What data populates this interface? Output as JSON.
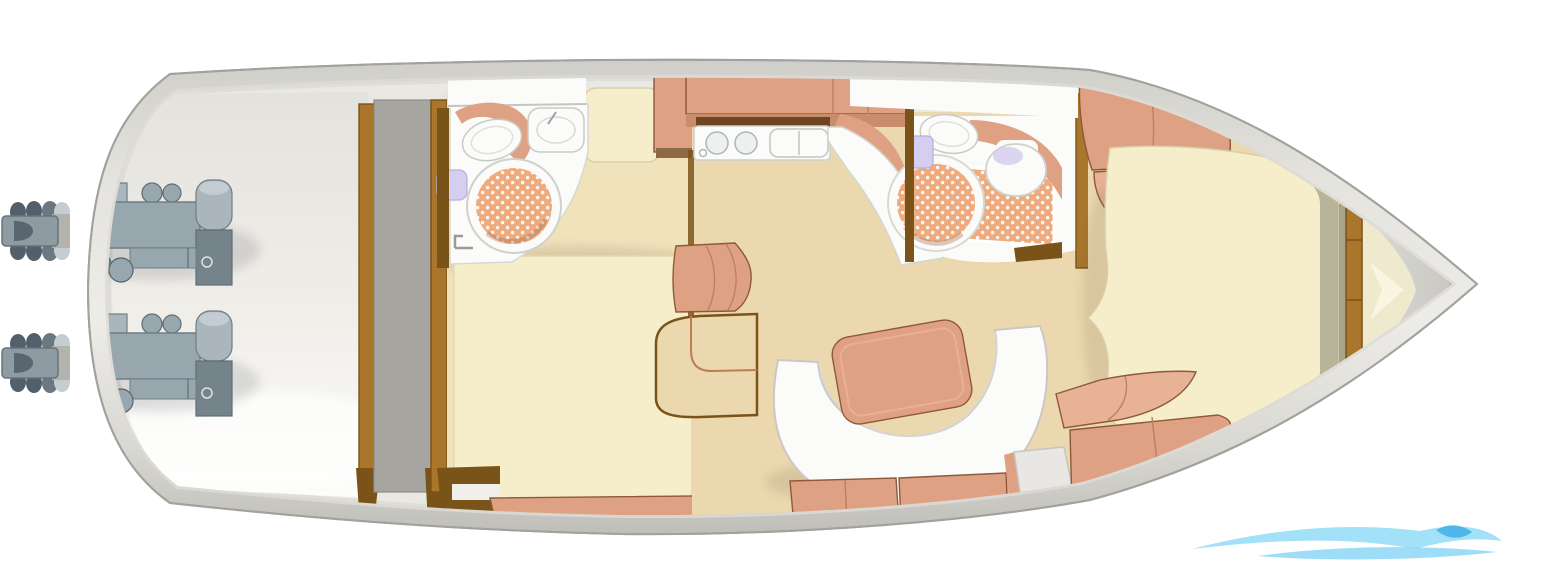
{
  "diagram": {
    "type": "floor-plan",
    "subject": "Motor yacht lower-deck interior layout, top-down view, bow pointing right",
    "orientation": "bow-right",
    "compartments": [
      "engine-room",
      "aft-head",
      "aft-cabin",
      "galley",
      "salon-dinette",
      "mid-head",
      "bow-cabin",
      "bow-deck"
    ],
    "features": [
      "twin-engines",
      "twin-stern-drives",
      "aft-shower",
      "aft-toilet",
      "aft-sink",
      "galley-burners",
      "galley-sink",
      "c-shaped-sofa",
      "dinette-table",
      "mid-shower",
      "mid-toilet",
      "mid-sink",
      "v-berth",
      "companionway-steps",
      "wave-logo-watermark"
    ]
  },
  "palette": {
    "background": "#ffffff",
    "hull_inner": "#e9e8e3",
    "deck_band_light": "#d8d7d2",
    "bow_deck_light": "#dddcd7",
    "engine_gray": "#98a6ae",
    "engine_gray_dark": "#75838b",
    "engine_gray_light": "#aab6bc",
    "drive_dark": "#51606c",
    "drive_body": "#8e9ba3",
    "wood": "#a9762c",
    "wood_dark": "#7a5318",
    "panel_gray": "#a7a5a0",
    "cream": "#f6eecb",
    "cream_floor": "#f0e2ba",
    "beige_floor": "#ecd8ae",
    "salmon": "#dfa184",
    "salmon_light": "#e8b297",
    "backsplash_brown": "#6e4423",
    "shower_tile": "#efab7e",
    "fixture_white": "#fbfbf9",
    "lavender": "#d6cef0",
    "olive": "#b7b499",
    "olive_dark": "#a8a58c",
    "steps_gray": "#e8e7e3",
    "bow_chevron": "#efe9cd",
    "bow_chevron_light": "#f9f5e2",
    "watermark_blue": "#9adef8",
    "watermark_blue_mid": "#7fd2f4",
    "watermark_blue_deep": "#3fb0e8"
  }
}
